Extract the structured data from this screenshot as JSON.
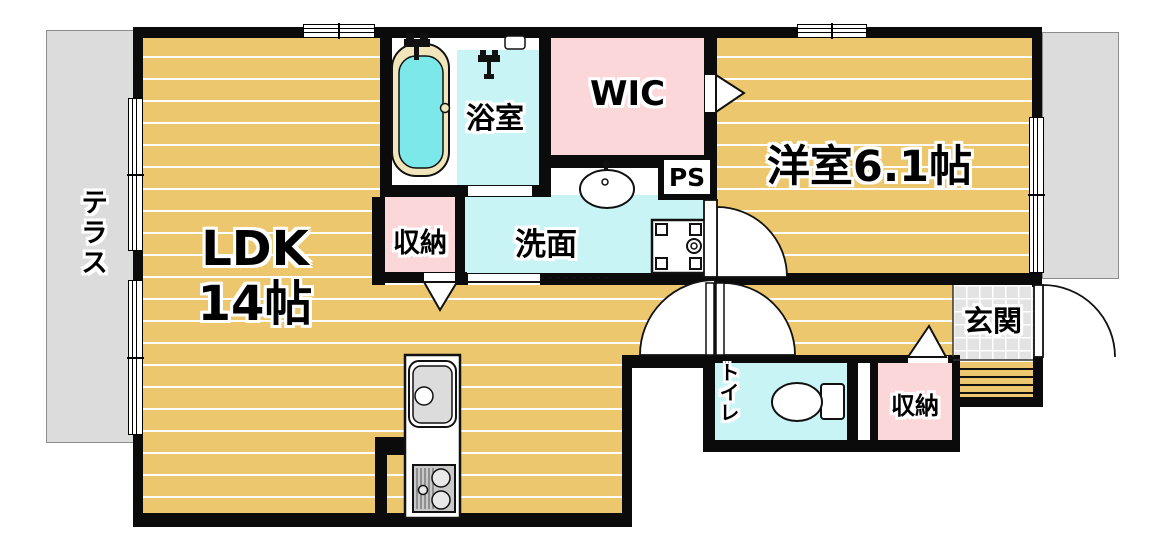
{
  "rooms": {
    "terrace": {
      "label": "テラス"
    },
    "ldk": {
      "name": "LDK",
      "size": "14帖"
    },
    "bath": {
      "label": "浴室"
    },
    "wic": {
      "label": "WIC"
    },
    "western_room": {
      "label": "洋室6.1帖"
    },
    "storage_upper": {
      "label": "収納"
    },
    "washroom": {
      "label": "洗面"
    },
    "pipe_space": {
      "label": "PS"
    },
    "toilet": {
      "label": "トイレ"
    },
    "storage_lower": {
      "label": "収納"
    },
    "entrance": {
      "label": "玄関"
    }
  },
  "colors": {
    "wall": "#0b0b0b",
    "tan": "#edc76d",
    "pink": "#fbd7da",
    "cyan": "#c9f4f6",
    "tub_water": "#7ce8e9",
    "tub_rim": "#f1e6bb",
    "outdoor": "#dcdcdc",
    "tile": "#e3e3e3"
  }
}
